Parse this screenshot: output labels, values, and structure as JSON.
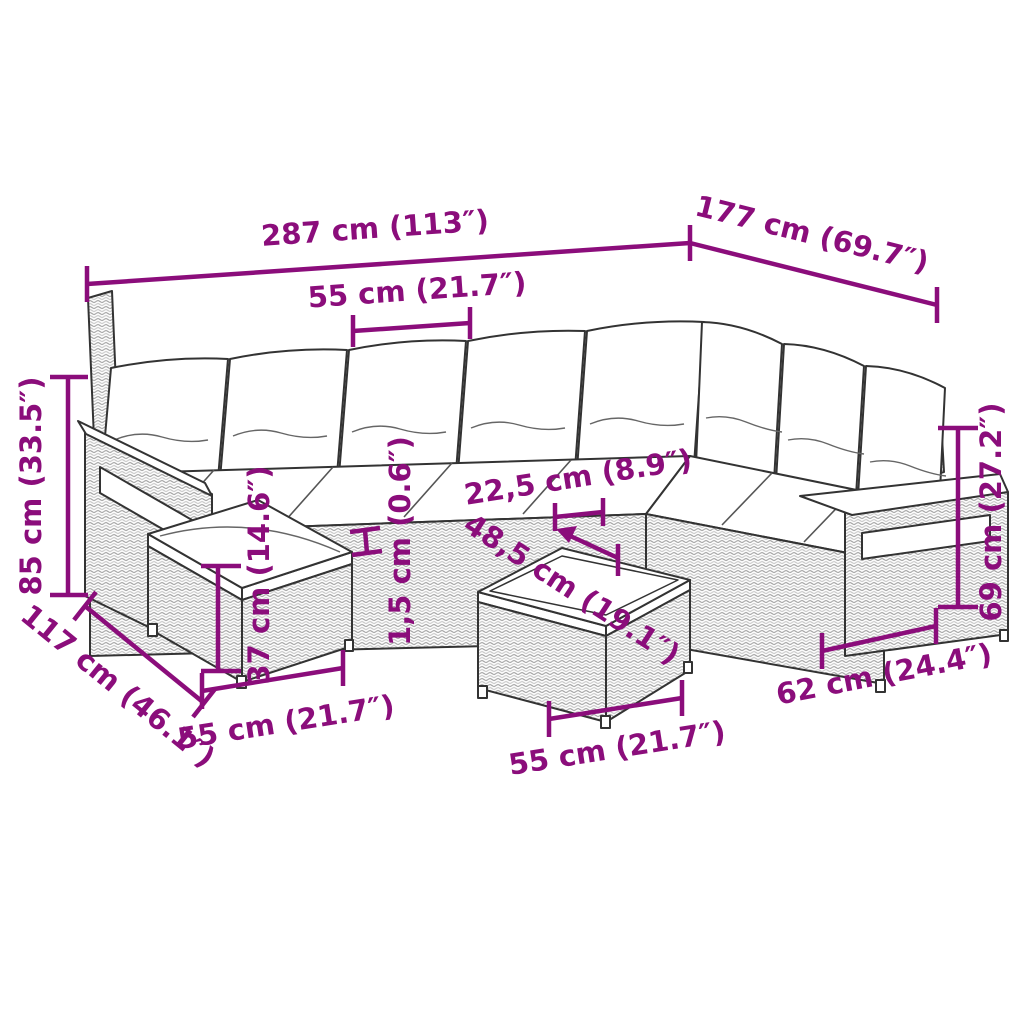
{
  "accent_color": "#8b0d7b",
  "line_color": "#333333",
  "labels": {
    "total_width": {
      "text": "287 cm (113″)"
    },
    "total_depth": {
      "text": "177 cm (69.7″)"
    },
    "seat_width": {
      "text": "55 cm (21.7″)"
    },
    "total_height": {
      "text": "85 cm (33.5″)"
    },
    "side_depth": {
      "text": "117 cm (46.1″)"
    },
    "stool_height": {
      "text": "37 cm (14.6″)"
    },
    "cushion_gap": {
      "text": "1,5 cm (0.6″)"
    },
    "armrest_width": {
      "text": "22,5 cm (8.9″)"
    },
    "table_depth": {
      "text": "48,5 cm (19.1″)"
    },
    "stool_width": {
      "text": "55 cm (21.7″)"
    },
    "table_width": {
      "text": "55 cm (21.7″)"
    },
    "seat_depth": {
      "text": "62 cm (24.4″)"
    },
    "armrest_height": {
      "text": "69 cm (27.2″)"
    }
  }
}
